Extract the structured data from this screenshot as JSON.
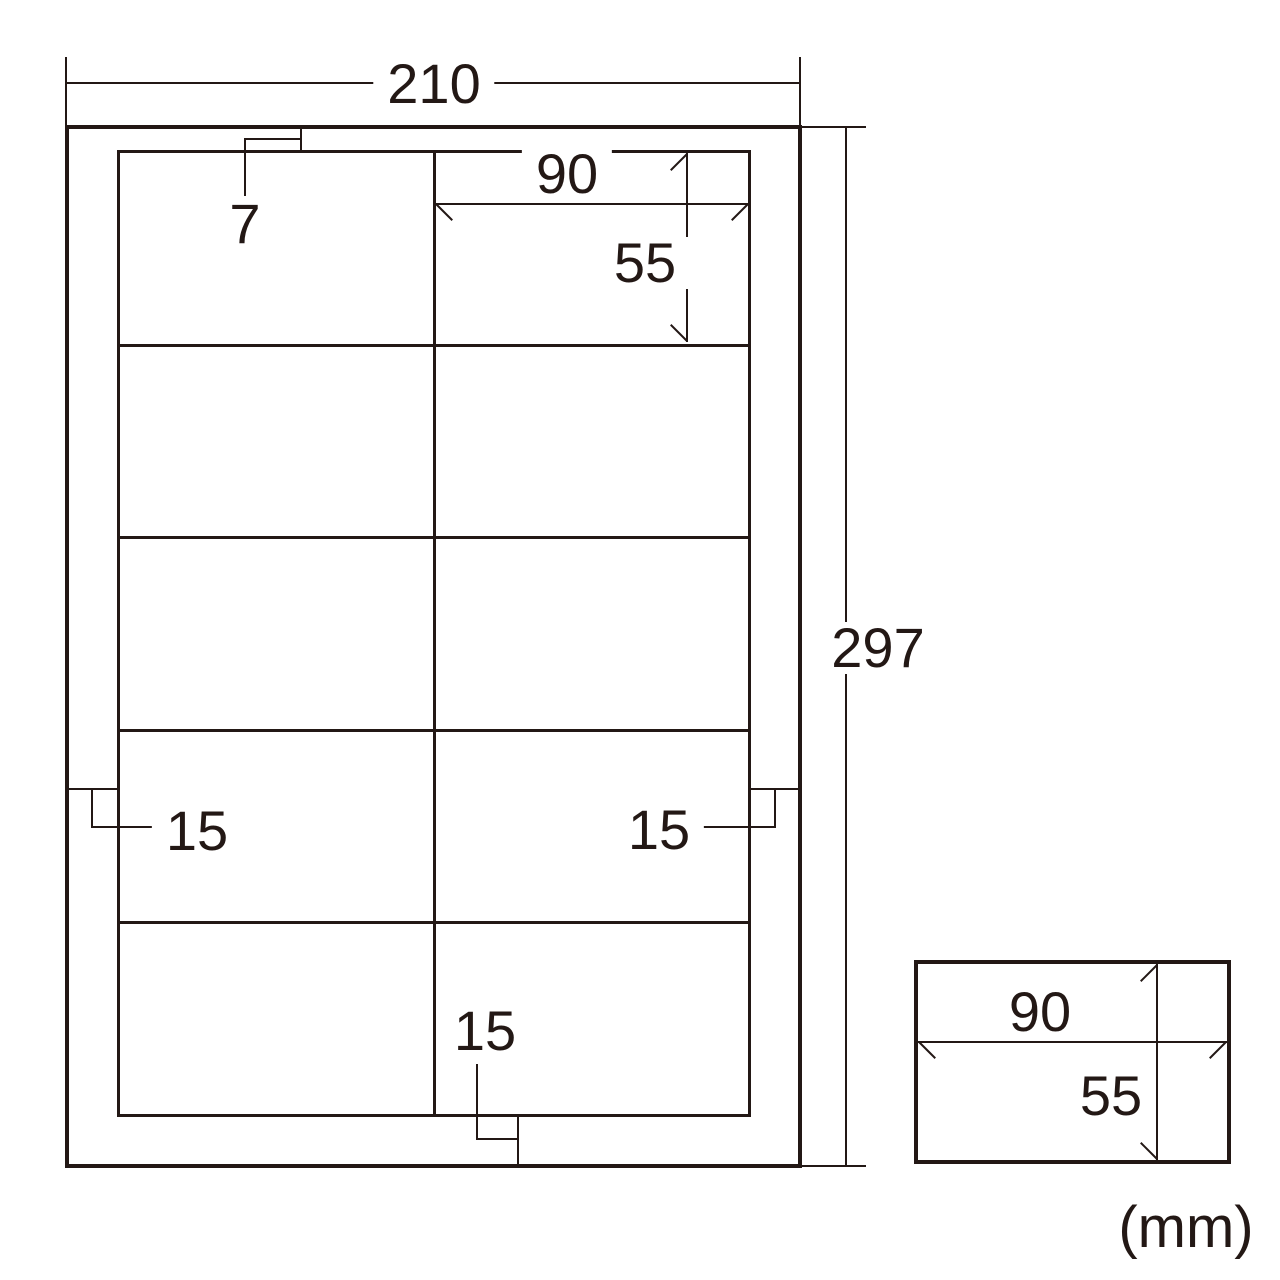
{
  "unit": "mm",
  "unit_label": "(mm)",
  "colors": {
    "line": "#231815",
    "background": "#ffffff"
  },
  "sheet": {
    "width": 210,
    "height": 297,
    "width_label": "210",
    "height_label": "297"
  },
  "grid": {
    "rows": 5,
    "columns": 2,
    "cell_count": 10
  },
  "label_cell": {
    "width": 90,
    "height": 55,
    "width_label": "90",
    "height_label": "55"
  },
  "margins": {
    "top": 7,
    "left": 15,
    "right": 15,
    "bottom": 15,
    "top_label": "7",
    "left_label": "15",
    "right_label": "15",
    "bottom_label": "15"
  },
  "detail_cell": {
    "width": 90,
    "height": 55,
    "width_label": "90",
    "height_label": "55"
  }
}
